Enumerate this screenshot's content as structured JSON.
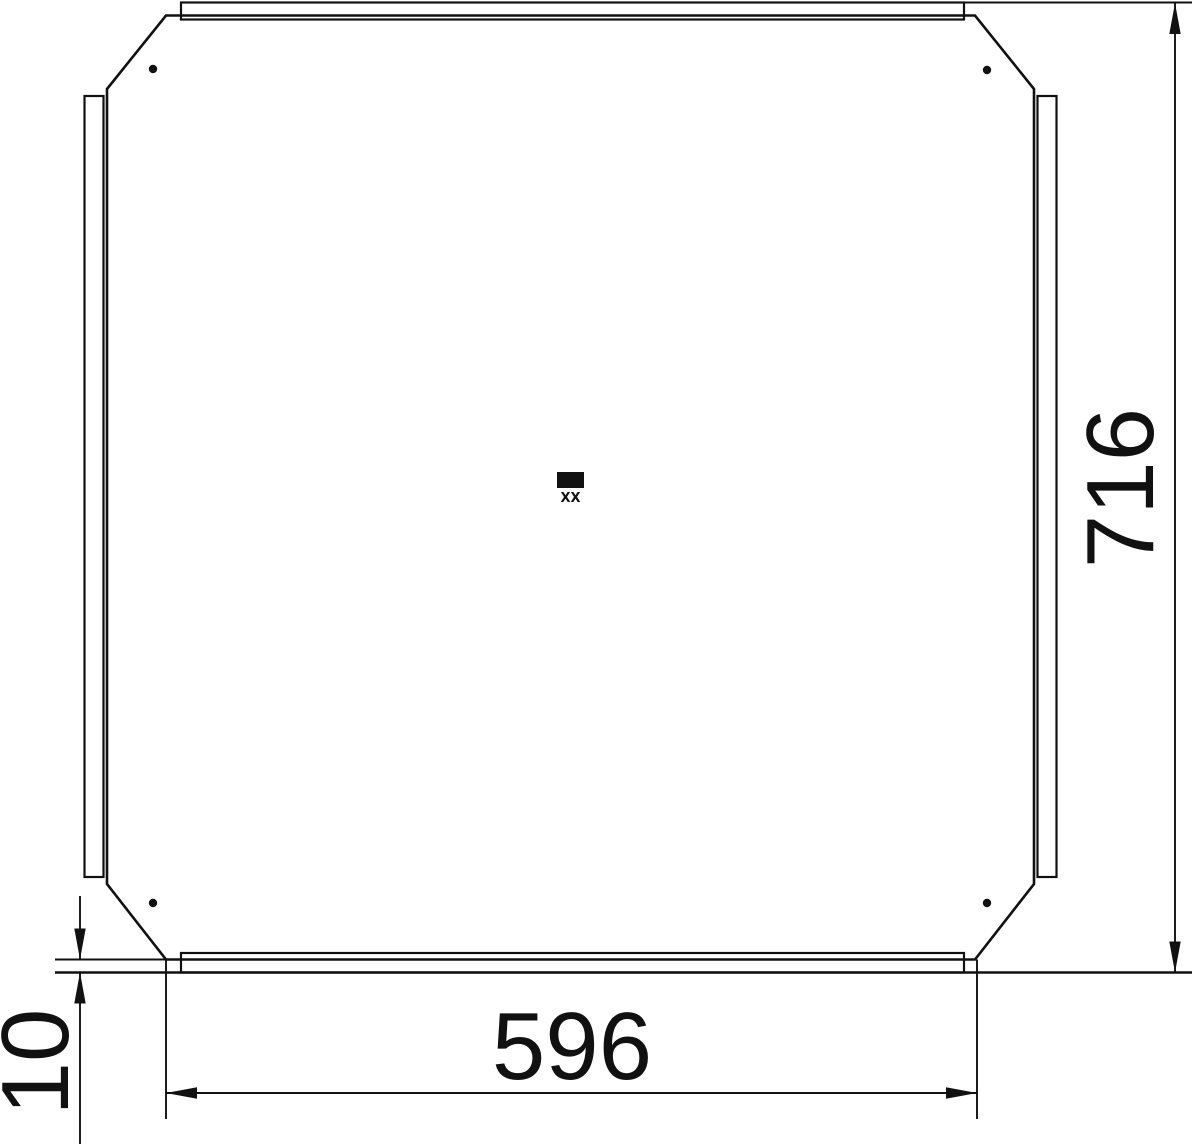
{
  "drawing": {
    "background_color": "#ffffff",
    "line_color": "#111111",
    "dimensions": {
      "overall_height": "716",
      "bottom_width": "596",
      "lip_offset": "10"
    },
    "center_stamp_text": "XX"
  }
}
